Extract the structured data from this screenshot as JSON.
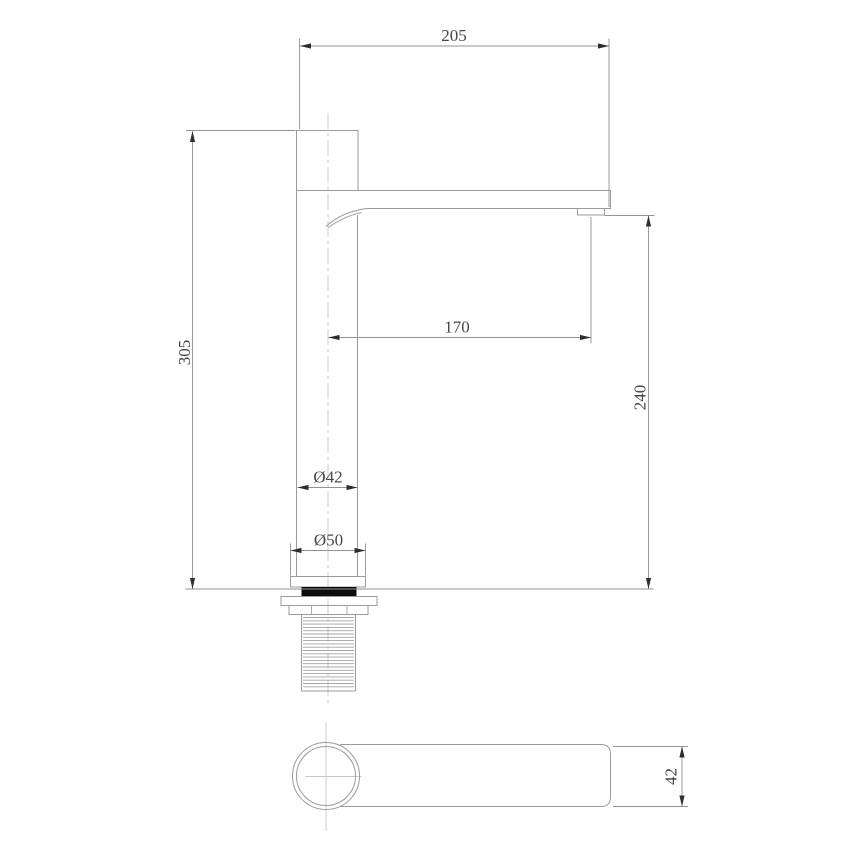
{
  "drawing": {
    "type": "faucet-installation-technical-drawing",
    "colors": {
      "background": "#ffffff",
      "outline": "#9b9b9b",
      "dimension_line": "#929292",
      "centerline": "#c7c7c7",
      "arrowhead": "#2e2e2e",
      "text": "#474747",
      "gasket_fill": "#0c0c0c"
    },
    "side_view": {
      "dimensions": {
        "overall_width": "205",
        "overall_height": "305",
        "spout_reach": "170",
        "spout_height": "240",
        "body_diameter": "Ø42",
        "base_diameter": "Ø50"
      }
    },
    "plan_view": {
      "dimensions": {
        "spout_width": "42"
      }
    }
  }
}
